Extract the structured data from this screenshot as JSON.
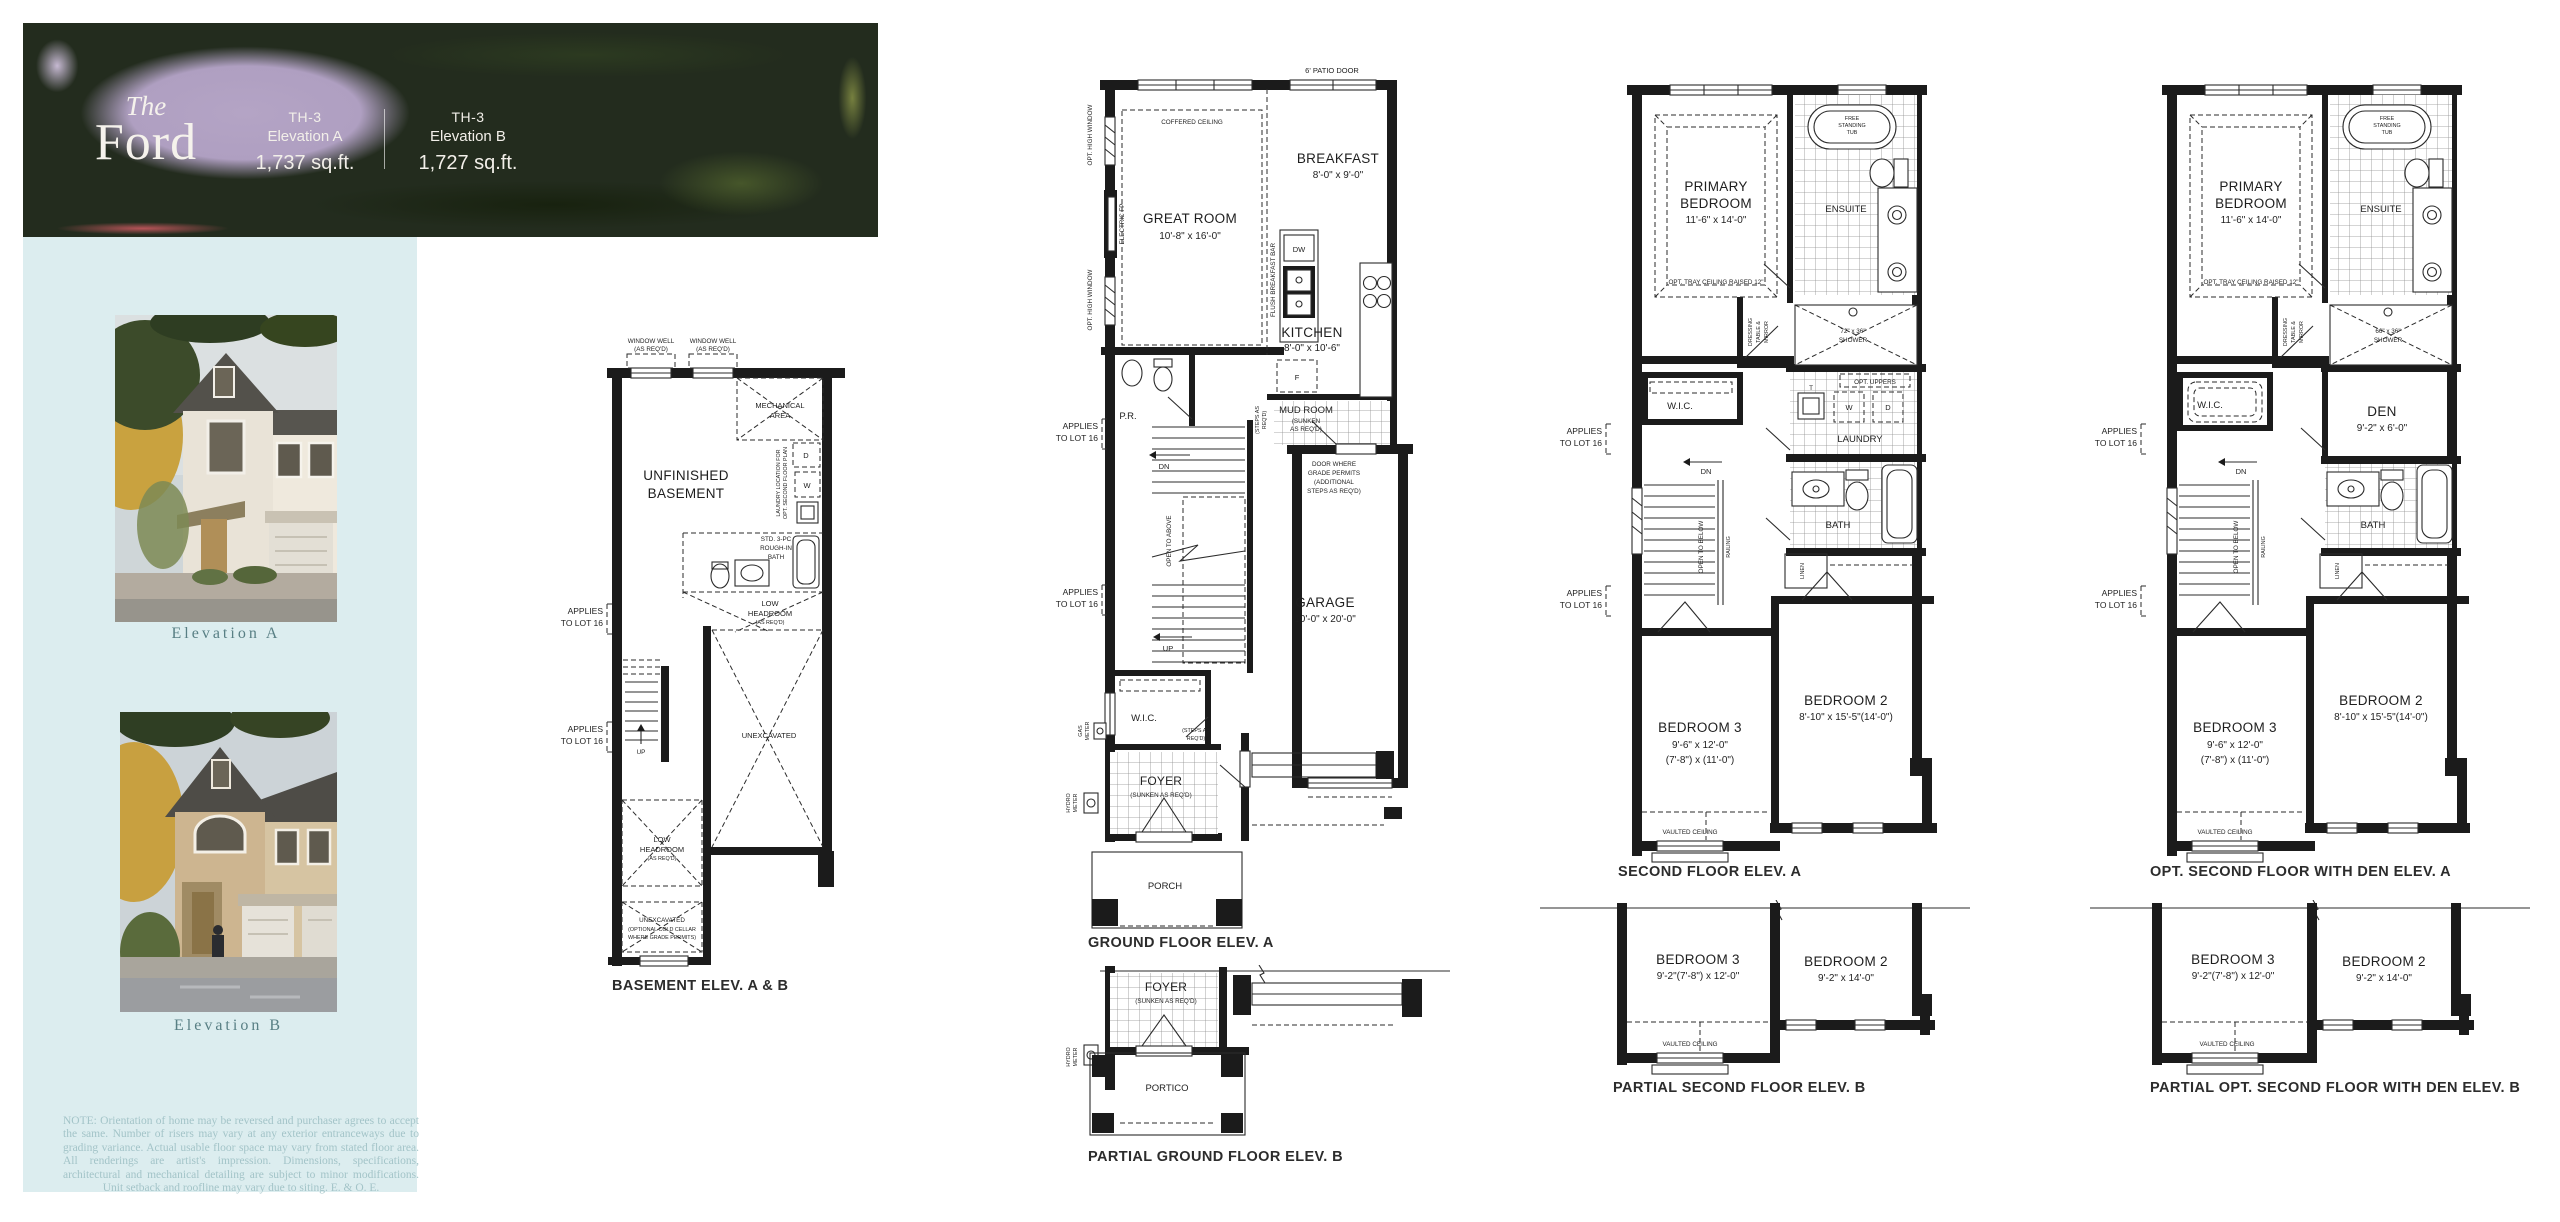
{
  "header": {
    "title_script": "The",
    "title_name": "Ford",
    "units": [
      {
        "model": "TH-3",
        "elevation": "Elevation A",
        "area": "1,737 sq.ft."
      },
      {
        "model": "TH-3",
        "elevation": "Elevation B",
        "area": "1,727 sq.ft."
      }
    ]
  },
  "sidebar": {
    "caption_a": "Elevation A",
    "caption_b": "Elevation B",
    "note": "NOTE: Orientation of home may be reversed and purchaser agrees to accept the same. Number of risers may vary at any exterior entranceways due to grading variance. Actual usable floor space may vary from stated floor area. All renderings are artist's impression. Dimensions, specifications, architectural and mechanical detailing are subject to minor modifications. Unit setback and roofline may vary due to siting. E. & O. E."
  },
  "common": {
    "applies_1": "APPLIES",
    "applies_2": "TO LOT 16",
    "vaulted": "VAULTED CEILING",
    "up": "UP",
    "dn": "DN",
    "open_above": "OPEN TO ABOVE",
    "open_below": "OPEN TO BELOW",
    "railing": "RAILING",
    "linen": "LINEN",
    "bath": "BATH",
    "wic": "W.I.C.",
    "laundry": "LAUNDRY",
    "unexcavated": "UNEXCAVATED",
    "steps_1": "(STEPS AS",
    "steps_2": "REQ'D)",
    "hydro_1": "HYDRO",
    "hydro_2": "METER",
    "gas_1": "GAS",
    "gas_2": "METER",
    "foyer": "FOYER",
    "sunken_foyer": "(SUNKEN AS REQ'D)",
    "low_1": "LOW",
    "low_2": "HEADROOM",
    "as_reqd": "(AS REQ'D)",
    "window_well": "WINDOW WELL",
    "bedroom2": "BEDROOM 2",
    "bedroom3": "BEDROOM 3",
    "primary_1": "PRIMARY",
    "primary_2": "BEDROOM",
    "primary_dims": "11'-6\" x 14'-0\"",
    "tray": "OPT. TRAY CEILING RAISED 12\"",
    "tub_1": "FREE",
    "tub_2": "STANDING",
    "tub_3": "TUB",
    "ensuite": "ENSUITE",
    "dress_1": "DRESSING",
    "dress_2": "TABLE &",
    "dress_3": "MIRROR",
    "shower": "SHOWER",
    "opt_uppers": "OPT. UPPERS",
    "t": "T",
    "w": "W",
    "d": "D",
    "f": "F",
    "dw": "DW",
    "pr": "P.R."
  },
  "basement": {
    "caption": "BASEMENT ELEV. A & B",
    "unfinished_1": "UNFINISHED",
    "unfinished_2": "BASEMENT",
    "mech_1": "MECHANICAL",
    "mech_2": "AREA",
    "laundry_loc_1": "LAUNDRY LOCATION FOR",
    "laundry_loc_2": "OPT. SECOND FLOOR PLAN",
    "bath_1": "STD. 3-PC",
    "bath_2": "ROUGH-IN",
    "bath_3": "BATH",
    "cold_1": "UNEXCAVATED",
    "cold_2": "(OPTIONAL COLD CELLAR",
    "cold_3": "WHERE GRADE PERMITS)"
  },
  "ground": {
    "caption": "GROUND FLOOR ELEV. A",
    "patio_door": "6' PATIO DOOR",
    "coffered": "COFFERED CEILING",
    "great_name": "GREAT ROOM",
    "great_dims": "10'-8\" x 16'-0\"",
    "breakfast_name": "BREAKFAST",
    "breakfast_dims": "8'-0\" x 9'-0\"",
    "kitchen_name": "KITCHEN",
    "kitchen_dims": "8'-0\" x 10'-6\"",
    "mud_1": "MUD ROOM",
    "mud_2": "(SUNKEN",
    "mud_3": "AS REQ'D)",
    "garage_name": "GARAGE",
    "garage_dims": "10'-0\" x 20'-0\"",
    "grade_1": "DOOR WHERE",
    "grade_2": "GRADE PERMITS",
    "grade_3": "(ADDITIONAL",
    "grade_4": "STEPS AS REQ'D)",
    "opt_high": "OPT. HIGH WINDOW",
    "electric_fp": "ELECTRIC FP",
    "flush_bar": "FLUSH BREAKFAST BAR",
    "porch": "PORCH"
  },
  "partial_ground": {
    "caption": "PARTIAL GROUND FLOOR ELEV. B",
    "portico": "PORTICO"
  },
  "second": {
    "caption": "SECOND FLOOR ELEV. A",
    "shower_dims": "72\" x 36\"",
    "bed3_dims1": "9'-6\" x 12'-0\"",
    "bed3_dims2": "(7'-8\") x (11'-0\")",
    "bed2_dims": "8'-10\" x 15'-5\"(14'-0\")"
  },
  "partial_second": {
    "caption": "PARTIAL SECOND FLOOR ELEV. B",
    "bed3_dims": "9'-2\"(7'-8\") x 12'-0\"",
    "bed2_dims": "9'-2\" x 14'-0\""
  },
  "opt_second": {
    "caption": "OPT. SECOND FLOOR WITH DEN ELEV. A",
    "den_name": "DEN",
    "den_dims": "9'-2\" x 6'-0\"",
    "shower_dims": "66\" x 36\""
  },
  "partial_opt": {
    "caption": "PARTIAL OPT. SECOND FLOOR WITH DEN ELEV. B"
  }
}
